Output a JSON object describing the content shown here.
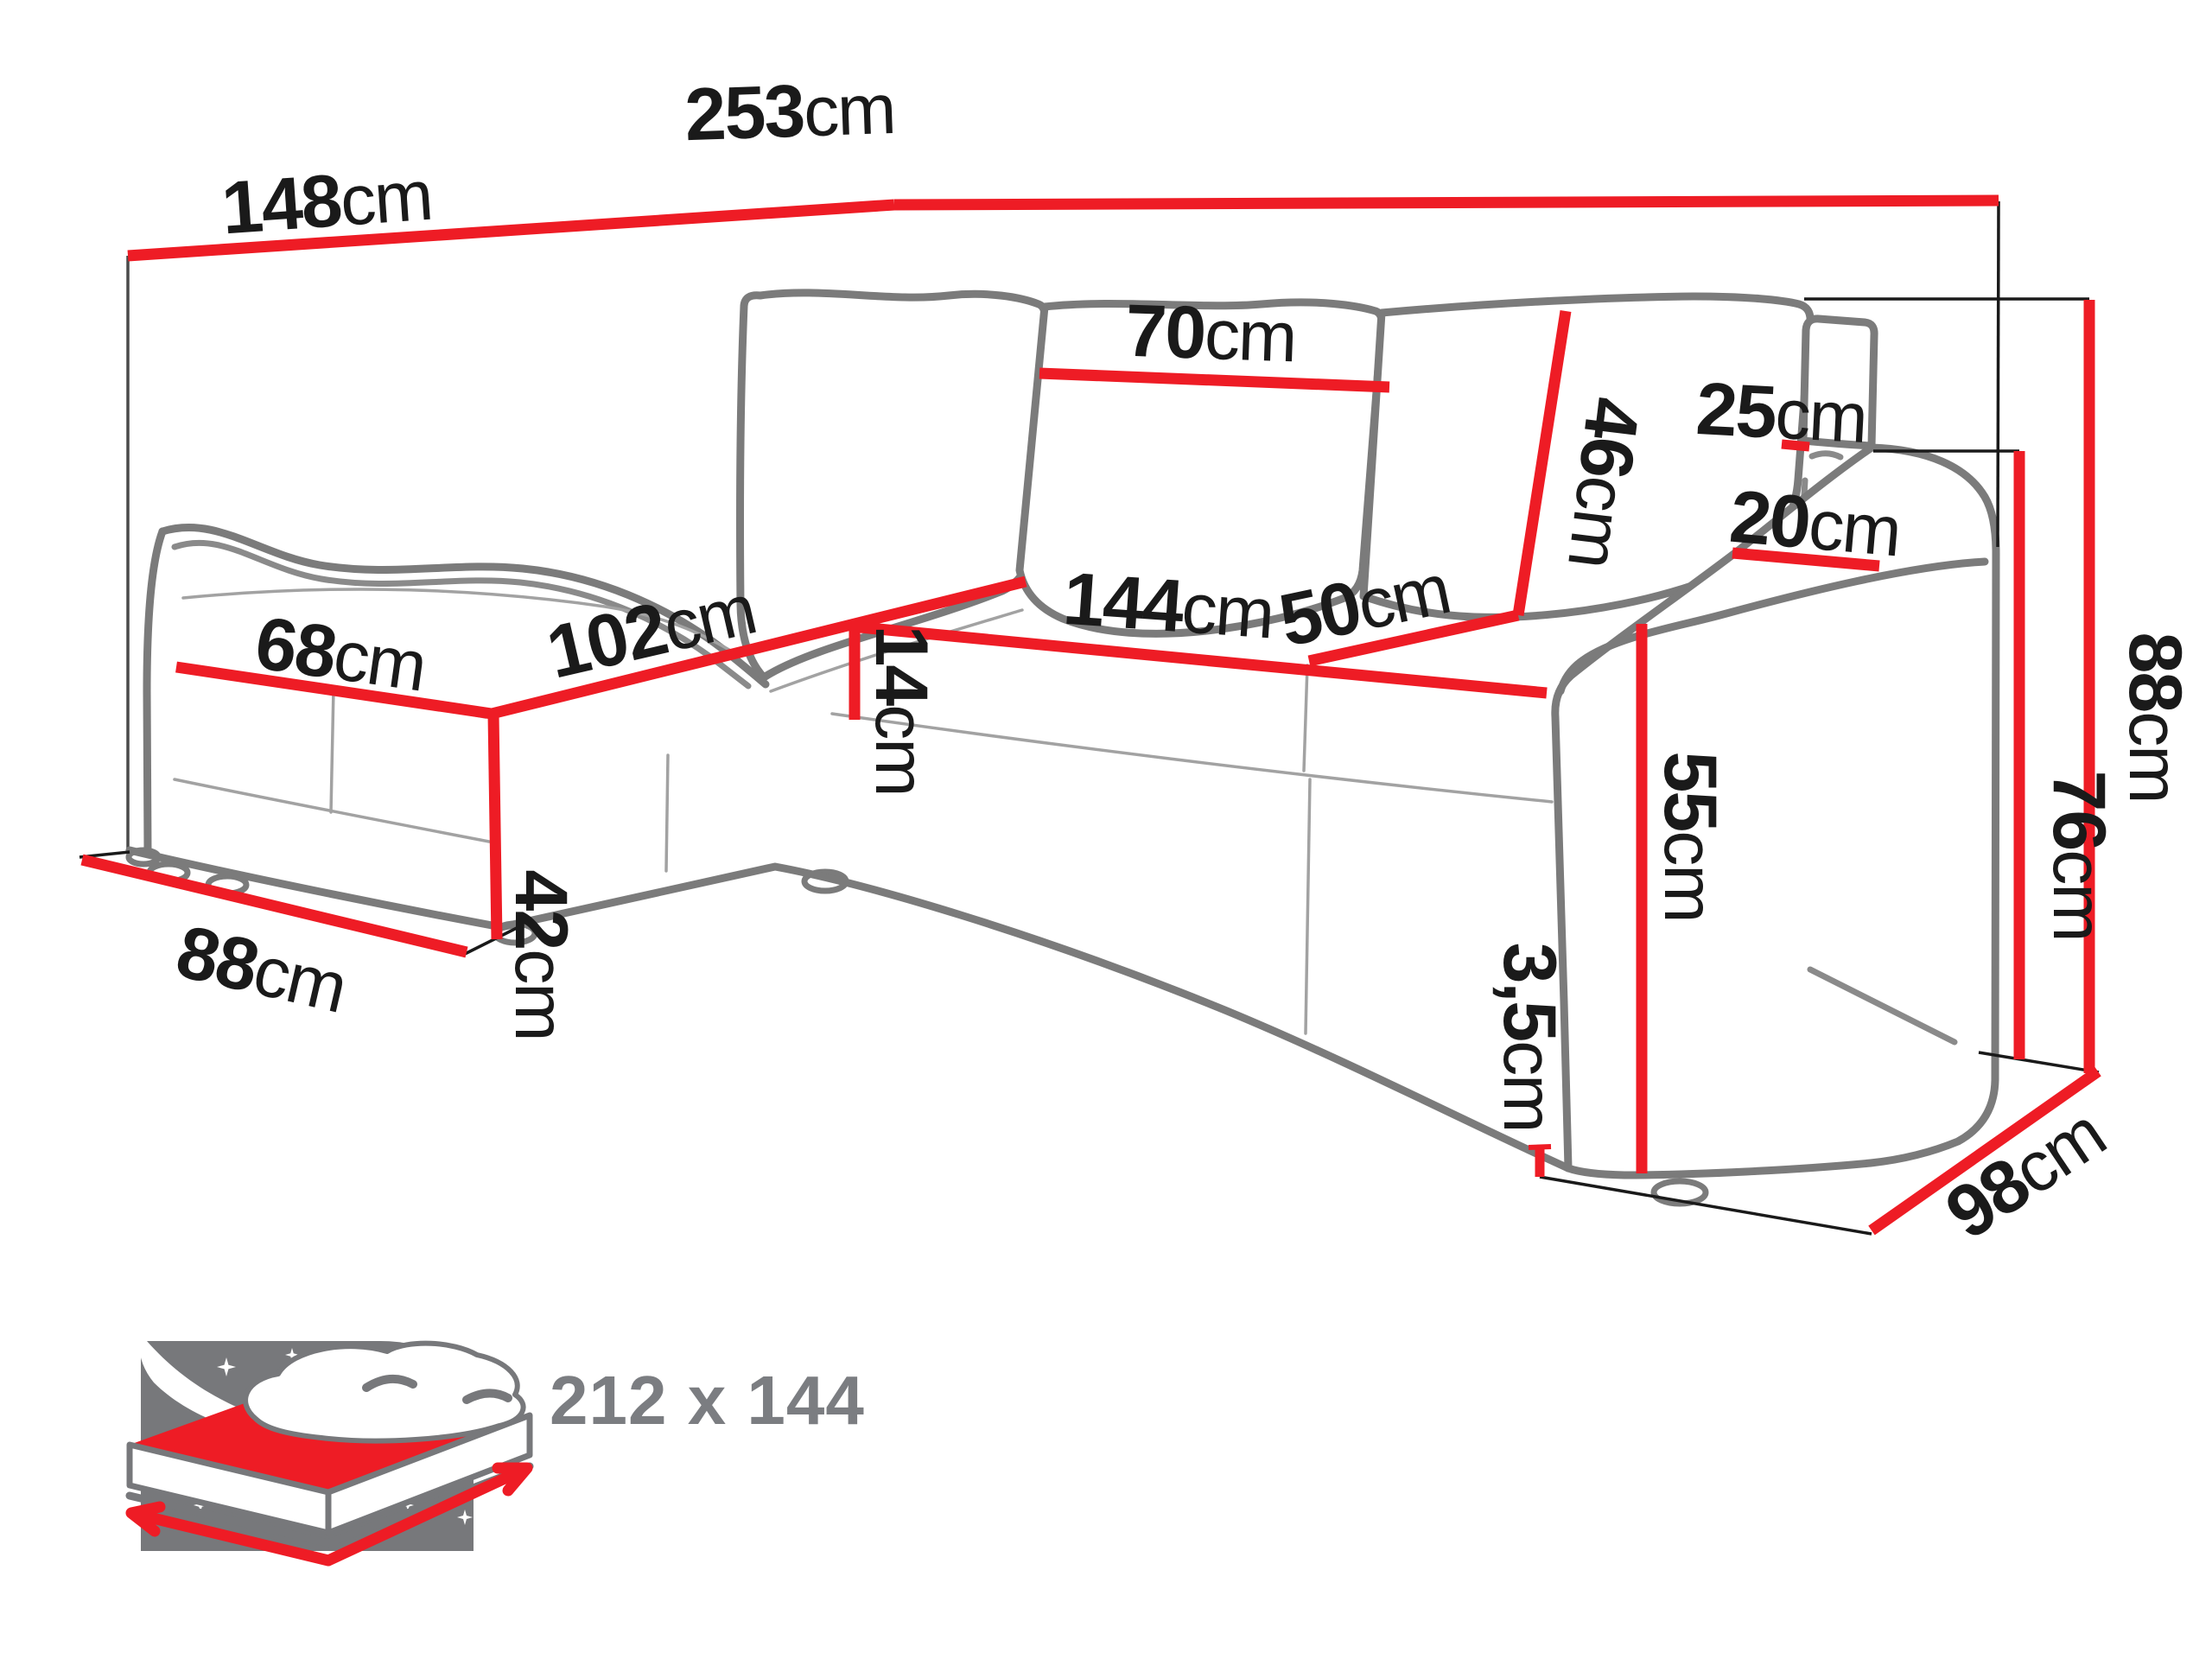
{
  "diagram": {
    "title": "Corner sofa bed dimension diagram",
    "unit": "cm",
    "dims": {
      "back_left_width": {
        "value": "148",
        "unit": "cm"
      },
      "total_length": {
        "value": "253",
        "unit": "cm"
      },
      "back_cushion_width": {
        "value": "70",
        "unit": "cm"
      },
      "headrest_width": {
        "value": "25",
        "unit": "cm"
      },
      "back_cushion_height": {
        "value": "46",
        "unit": "cm"
      },
      "armrest_top_width": {
        "value": "20",
        "unit": "cm"
      },
      "total_height": {
        "value": "88",
        "unit": "cm"
      },
      "armrest_height": {
        "value": "76",
        "unit": "cm"
      },
      "chaise_front_width": {
        "value": "68",
        "unit": "cm"
      },
      "chaise_seat_length": {
        "value": "102",
        "unit": "cm"
      },
      "seat_front_length": {
        "value": "144",
        "unit": "cm"
      },
      "seat_depth": {
        "value": "50",
        "unit": "cm"
      },
      "seat_cushion_height": {
        "value": "14",
        "unit": "cm"
      },
      "chaise_front_height": {
        "value": "42",
        "unit": "cm"
      },
      "armrest_front_height": {
        "value": "55",
        "unit": "cm"
      },
      "leg_height": {
        "value": "3,5",
        "unit": "cm"
      },
      "chaise_side_depth": {
        "value": "88",
        "unit": "cm"
      },
      "sofa_side_depth": {
        "value": "98",
        "unit": "cm"
      }
    },
    "sleeping_function": {
      "size_label": "212 x 144"
    },
    "colors": {
      "dimension_line": "#ee1c25",
      "sofa_outline": "#7b7b7b",
      "icon_gray": "#77787b",
      "label_text": "#1a1a1a",
      "icon_label_text": "#7b7d81"
    }
  }
}
